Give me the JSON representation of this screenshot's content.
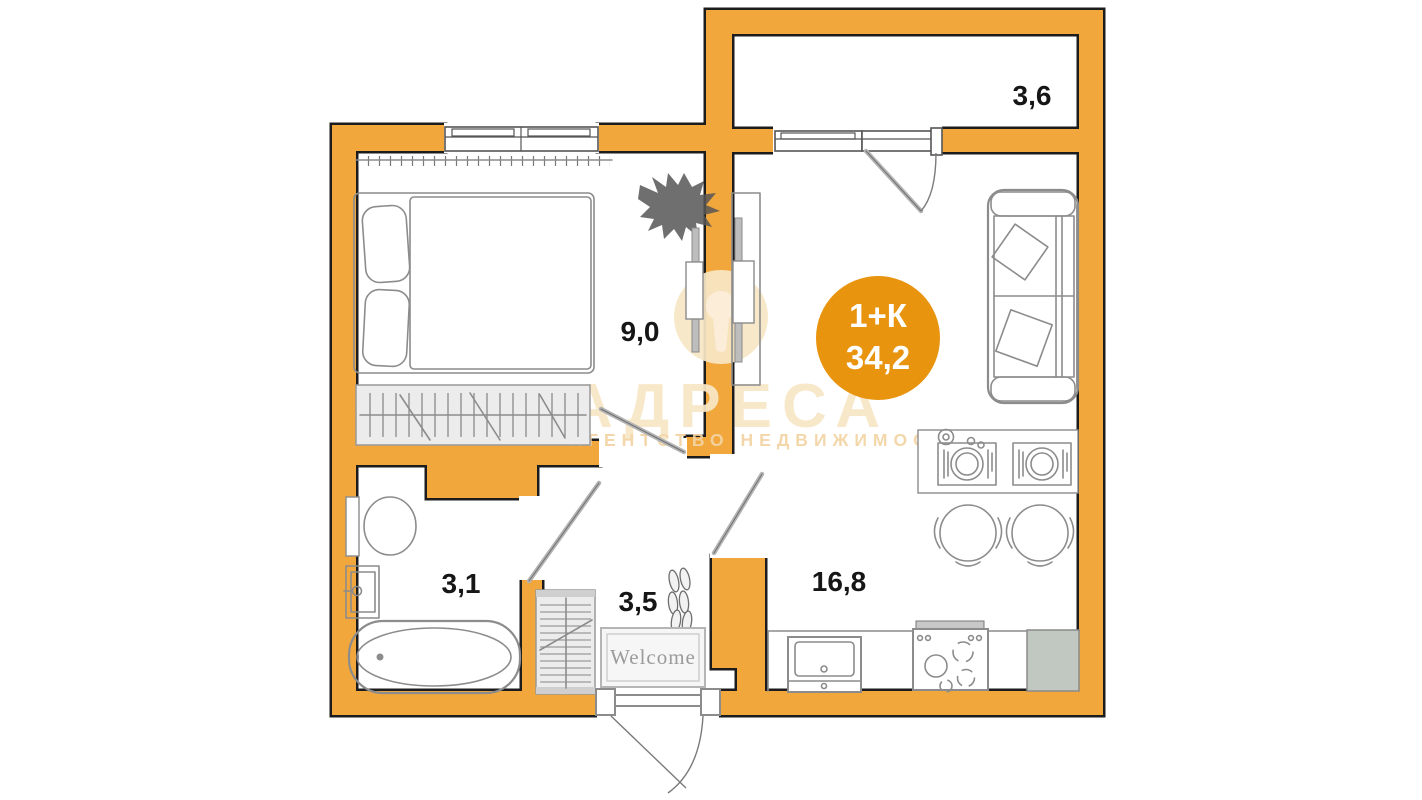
{
  "plan": {
    "badge": {
      "type_label": "1+К",
      "area_label": "34,2",
      "color": "#E8940F",
      "text_color": "#FFFFFF"
    },
    "rooms": [
      {
        "name": "bedroom",
        "area_label": "9,0"
      },
      {
        "name": "balcony",
        "area_label": "3,6"
      },
      {
        "name": "bathroom",
        "area_label": "3,1"
      },
      {
        "name": "hallway",
        "area_label": "3,5"
      },
      {
        "name": "kitchen-living",
        "area_label": "16,8"
      }
    ],
    "doormat_label": "Welcome"
  },
  "watermark": {
    "brand": "АДРЕСА",
    "tagline": "АГЕНТСТВО НЕДВИЖИМОСТИ"
  },
  "colors": {
    "wall": "#F1A73C",
    "outline": "#1C1C1C",
    "sketch": "#8C8C8C",
    "label": "#161616",
    "watermark_brand": "#F8E7C6",
    "watermark_tagline": "#F3D5A5",
    "fixture_fill": "#ECECEC",
    "fridge_fill": "#C1C8C1",
    "background": "#FFFFFF"
  }
}
